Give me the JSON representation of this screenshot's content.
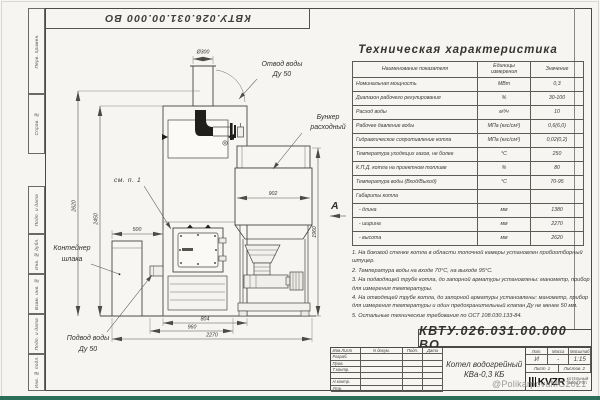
{
  "page": {
    "doc_number": "КВТУ.026.031.00.000  ВО",
    "watermark": "@PolikarpovaMG2021"
  },
  "frame_strip": {
    "labels": [
      "Перв. примен.",
      "Справ. №",
      "Подп. и дата",
      "Инв. № дубл.",
      "Взам. инв. №",
      "Подп. и дата",
      "Инв. № подл."
    ]
  },
  "drawing": {
    "labels": {
      "water_outlet_1": "Отвод воды",
      "water_outlet_2": "Ду 50",
      "bunker_1": "Бункер",
      "bunker_2": "расходный",
      "see_note": "см. п. 1",
      "slag_container_1": "Контейнер",
      "slag_container_2": "шлака",
      "water_inlet_1": "Подвод воды",
      "water_inlet_2": "Ду 50",
      "view_a": "А"
    },
    "dims": {
      "chimney_d": "Ø300",
      "bunker_w": "902",
      "slag_offset": "500",
      "height_total": "2620",
      "height_boiler": "2450",
      "height_bunker": "1960",
      "base_inner": "804",
      "base_outer": "960",
      "width_total": "2270"
    }
  },
  "spec_table": {
    "title": "Техническая характеристика",
    "col_name": "Наименование показателя",
    "col_units": "Единицы измерения",
    "col_value": "Значение",
    "rows": [
      {
        "name": "Номинальная мощность",
        "units": "МВт",
        "value": "0,3"
      },
      {
        "name": "Диапазон рабочего регулирования",
        "units": "%",
        "value": "30-100"
      },
      {
        "name": "Расход воды",
        "units": "м³/ч",
        "value": "10"
      },
      {
        "name": "Рабочее давление воды",
        "units": "МПа (кгс/см²)",
        "value": "0,6(6,0)"
      },
      {
        "name": "Гидравлическое сопротивление котла",
        "units": "МПа (кгс/см²)",
        "value": "0,02(0,2)"
      },
      {
        "name": "Температура уходящих газов, не более",
        "units": "°С",
        "value": "250"
      },
      {
        "name": "К.П.Д. котла на проектном топливе",
        "units": "%",
        "value": "80"
      },
      {
        "name": "Температура воды (Вход/Выход)",
        "units": "°С",
        "value": "70-95"
      },
      {
        "name": "Габариты котла",
        "units": "",
        "value": ""
      },
      {
        "name": "  - длина",
        "units": "мм",
        "value": "1380"
      },
      {
        "name": "  - ширина",
        "units": "мм",
        "value": "2270"
      },
      {
        "name": "  - высота",
        "units": "мм",
        "value": "2620"
      }
    ]
  },
  "notes": [
    "1. На боковой стенке котла в области топочной камеры установлен пробоотборный штуцер.",
    "2. Температура воды на входе 70°С, на выходе 95°С.",
    "3. На подводящей трубе котла, до запорной арматуры установлены: манометр, прибор для измерения температуры.",
    "4. На отводящей трубе котла, до запорной арматуры установлены: манометр, прибор для измерения температуры и один предохранительный клапан Ду не менее 50 мм.",
    "5. Остальные технические требования по ОСТ 108.030.133-84."
  ],
  "title_block": {
    "header": {
      "izm": "Изм.Лист",
      "doc": "N докум.",
      "sign": "Подп.",
      "date": "Дата"
    },
    "rows": [
      "Разраб.",
      "Пров.",
      "Т.контр.",
      "",
      "Н.контр.",
      "Утв."
    ],
    "doc_title_1": "Котел водогрейный",
    "doc_title_2": "КВа-0,3  КБ",
    "lit_label": "Лит.",
    "mass_label": "Масса",
    "scale_label": "Масштаб",
    "lit_value": "И",
    "mass_value": "-",
    "scale_value": "1:15",
    "sheet_label": "Лист",
    "sheet_value": "1",
    "sheets_label": "Листов",
    "sheets_value": "2",
    "logo_text": "KVZR",
    "logo_sub_1": "КОТЕЛЬНЫЙ",
    "logo_sub_2": "ЗАВОД РЭП"
  }
}
